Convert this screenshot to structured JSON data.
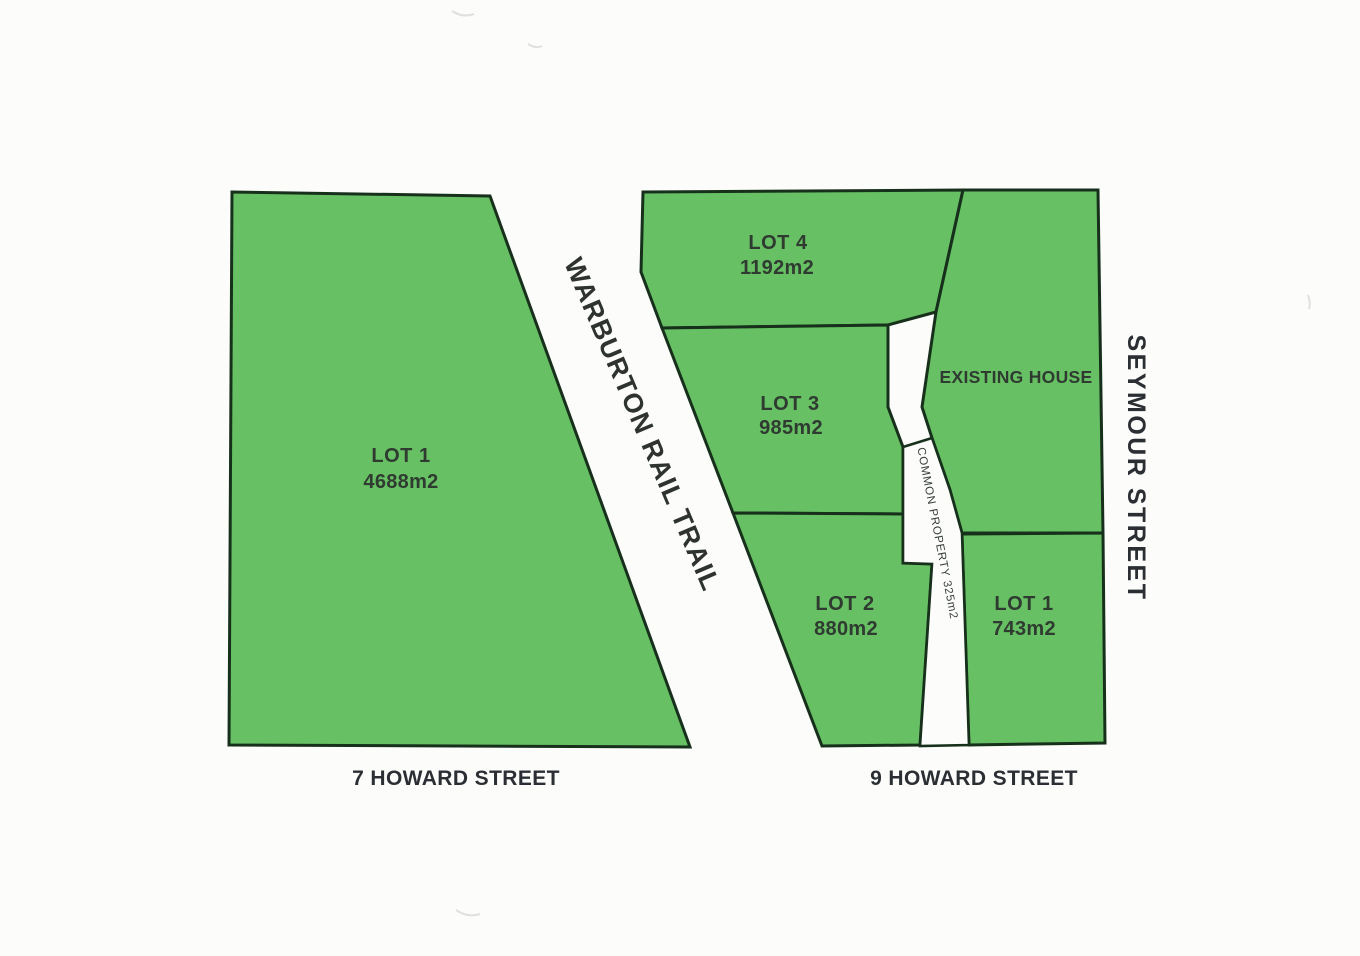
{
  "plan": {
    "colors": {
      "parcel_fill": "#67c063",
      "boundary": "#17301c",
      "label_text": "#2f3a31",
      "street_text": "#2b2f33",
      "page_bg": "#fcfcfb"
    },
    "streets": {
      "left": "7 HOWARD STREET",
      "right": "9 HOWARD STREET",
      "side": "SEYMOUR STREET",
      "trail": "WARBURTON RAIL TRAIL"
    },
    "parcels": {
      "lot1_west": {
        "label": "LOT 1",
        "area": "4688m2"
      },
      "lot4": {
        "label": "LOT 4",
        "area": "1192m2"
      },
      "lot3": {
        "label": "LOT 3",
        "area": "985m2"
      },
      "lot2": {
        "label": "LOT 2",
        "area": "880m2"
      },
      "lot1_east": {
        "label": "LOT 1",
        "area": "743m2"
      },
      "existing_house": {
        "label": "EXISTING HOUSE"
      },
      "common_property": {
        "label": "COMMON PROPERTY 325m2"
      }
    }
  }
}
